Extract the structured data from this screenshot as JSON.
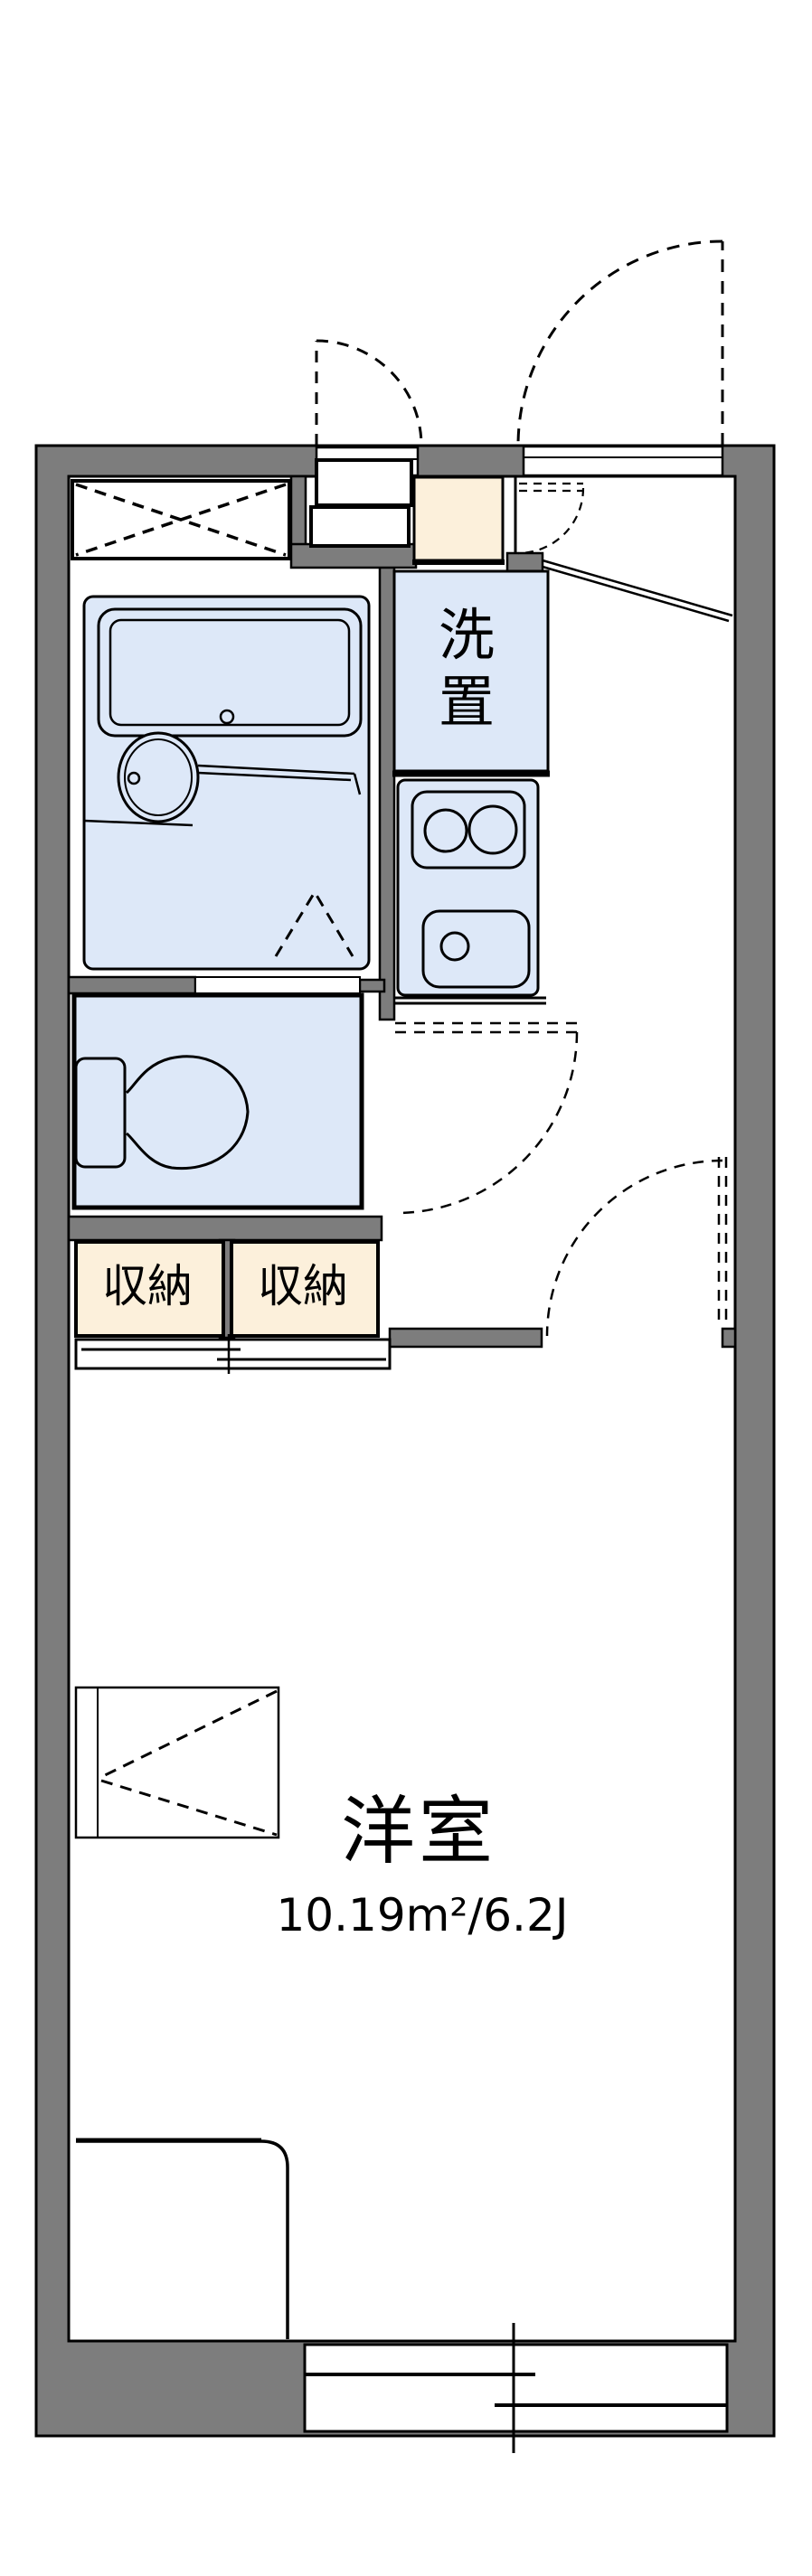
{
  "plan": {
    "type": "apartment-floor-plan",
    "labels": {
      "washer": "洗置",
      "storage_left": "収納",
      "storage_right": "収納",
      "room_name": "洋室",
      "room_area": "10.19m²/6.2J"
    },
    "colors": {
      "wall": "#7d7d7d",
      "fixture_fill": "#dde8f8",
      "storage_fill": "#fcf0db",
      "line": "#000000",
      "background": "#ffffff"
    }
  }
}
